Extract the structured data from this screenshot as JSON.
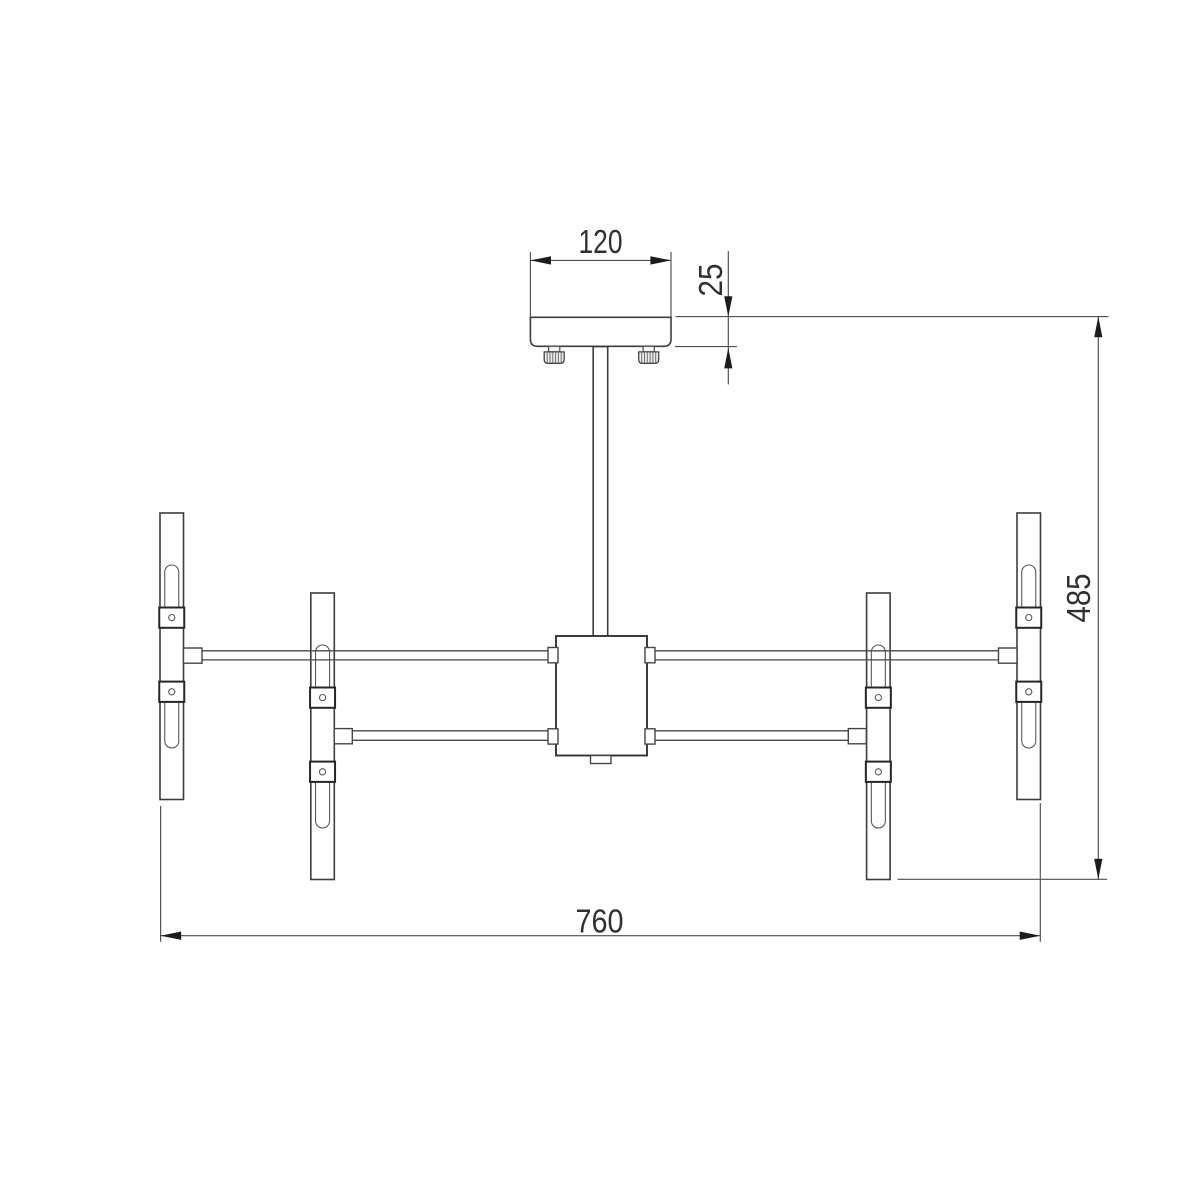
{
  "drawing": {
    "dimensions": {
      "canopy_width": "120",
      "canopy_thickness": "25",
      "overall_height": "485",
      "overall_width": "760"
    },
    "colors": {
      "background": "#ffffff",
      "part_line": "#3d3d3d",
      "dimension_line": "#4f4f4f",
      "arrow": "#1c1c1c",
      "text": "#303030"
    }
  }
}
